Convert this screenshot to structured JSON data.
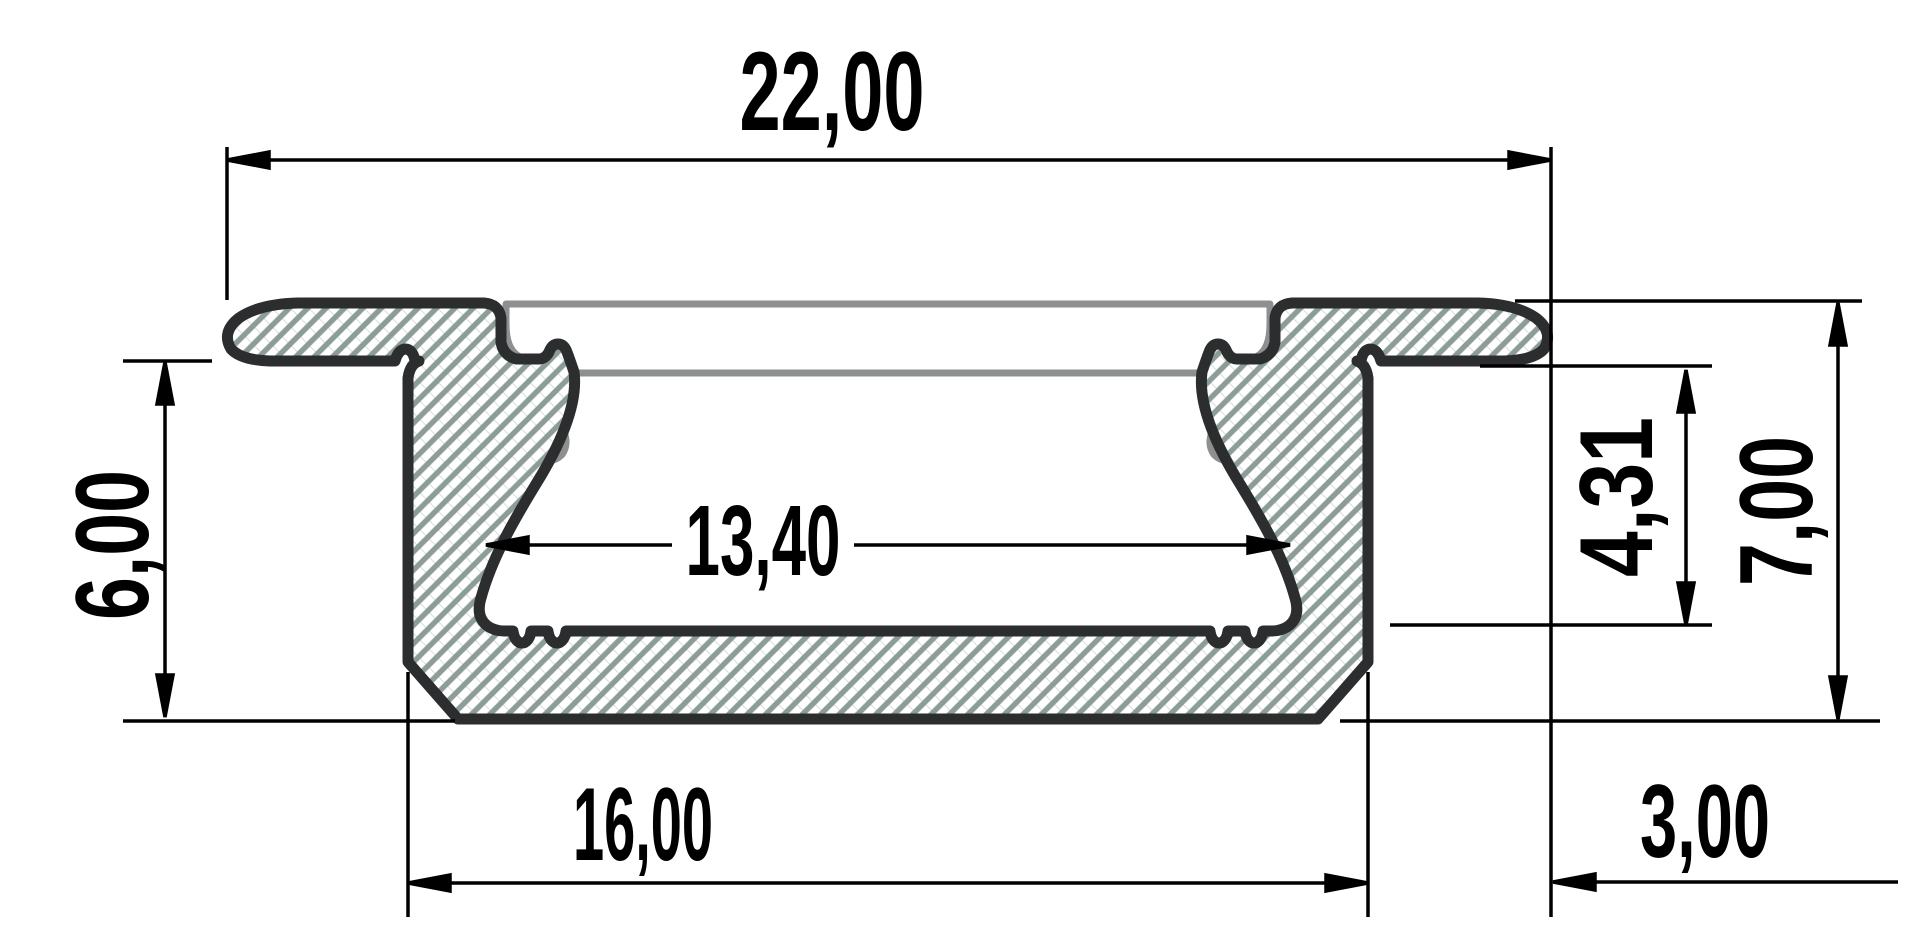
{
  "drawing": {
    "kind": "technical-cross-section",
    "subject": "recessed aluminium LED profile with diffuser cover",
    "units": "mm",
    "decimal_separator": ",",
    "labels": {
      "overall_width": "22,00",
      "opening_width": "13,40",
      "body_width": "16,00",
      "flange_overhang": "3,00",
      "body_depth": "6,00",
      "cavity_depth": "4,31",
      "overall_height": "7,00"
    },
    "colors": {
      "background": "#ffffff",
      "outline": "#2b2d2f",
      "hatch": "#8c9c97",
      "hatch_cross": "#ccd7d2",
      "cover": "#8e9090",
      "dimension": "#000000"
    }
  }
}
